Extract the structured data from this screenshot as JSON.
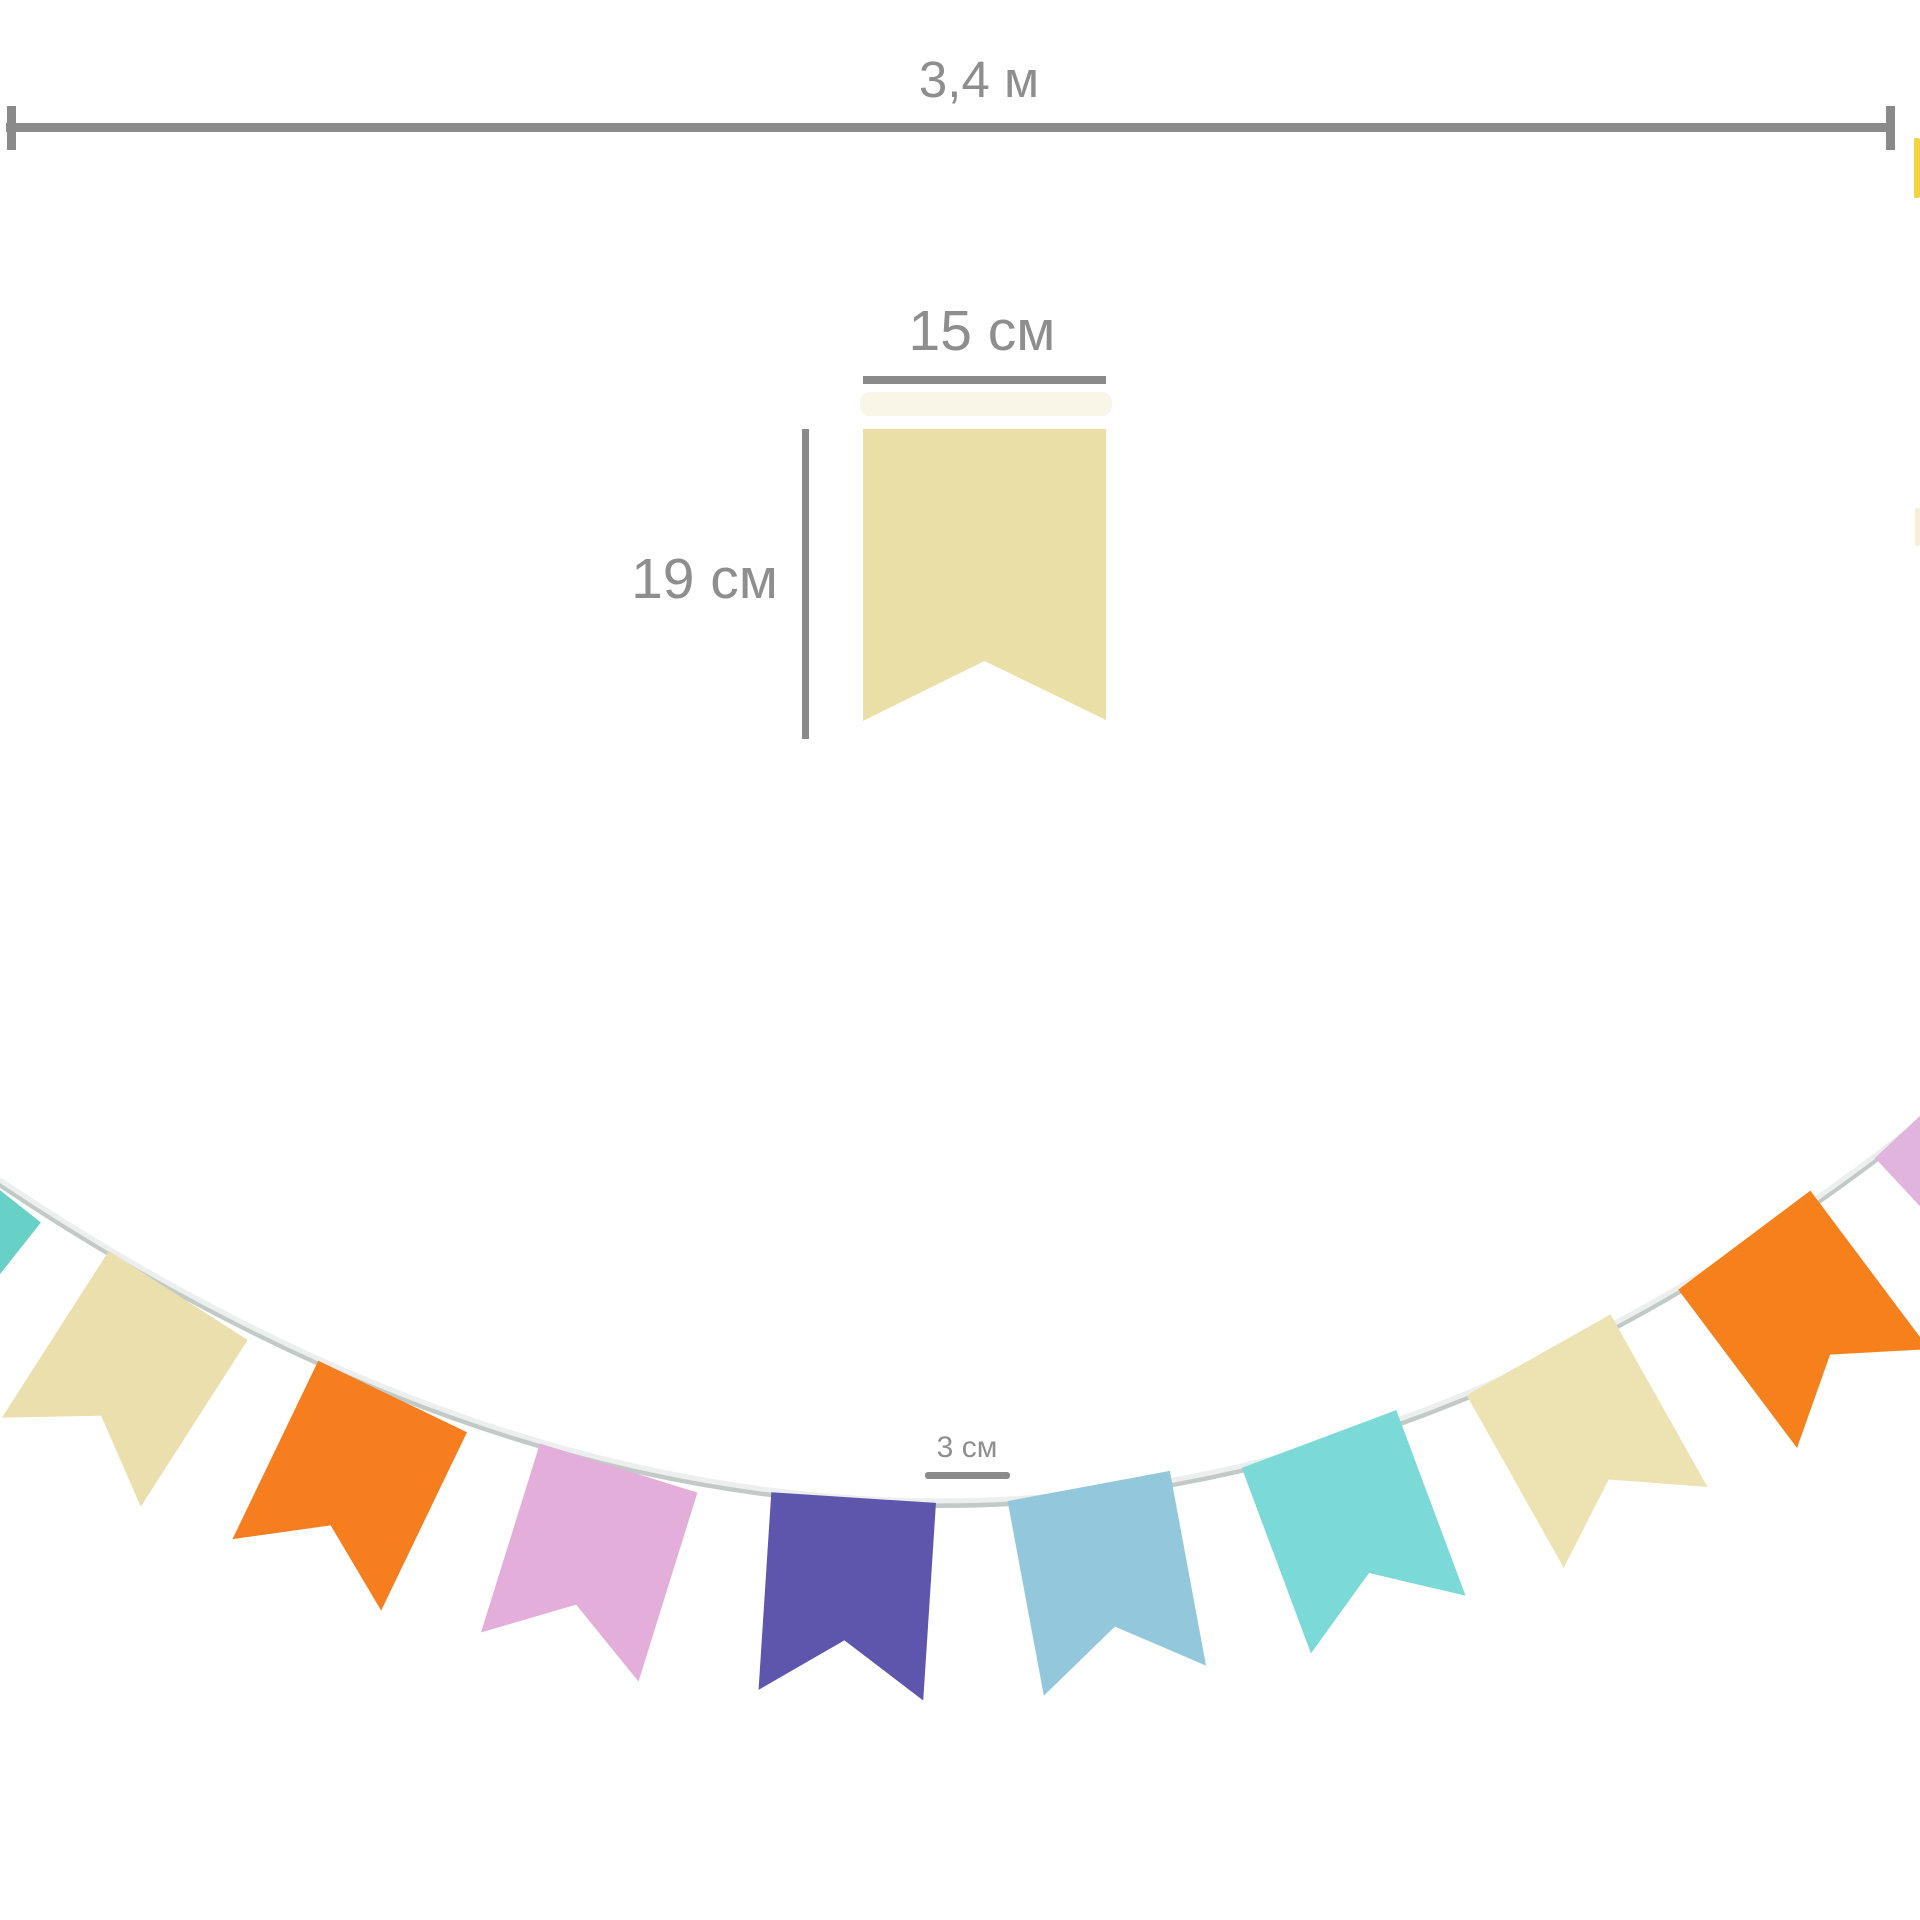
{
  "labels": {
    "total_length": "3,4 м",
    "flag_width": "15 см",
    "flag_height": "19 см",
    "flag_spacing": "3 см"
  },
  "colors": {
    "background": "#ffffff",
    "measure_line": "#8a8a8a",
    "label_text": "#8e8e8e",
    "diagram_flag": "#EADFA6",
    "diagram_flag_glow": "#EDE5BC",
    "cord": "#ECEFED",
    "cord_shadow": "#C2CAC7"
  },
  "garland": {
    "flag_colors": [
      "#67D1C8",
      "#EBDFAE",
      "#F67E1F",
      "#E3AFDA",
      "#5D56AC",
      "#93C8DC",
      "#7BD9D7",
      "#EDE2B2",
      "#F5801C",
      "#E0B4DC"
    ],
    "edge_fragment_colors": [
      "#F0D440",
      "#F5EFD8"
    ]
  }
}
